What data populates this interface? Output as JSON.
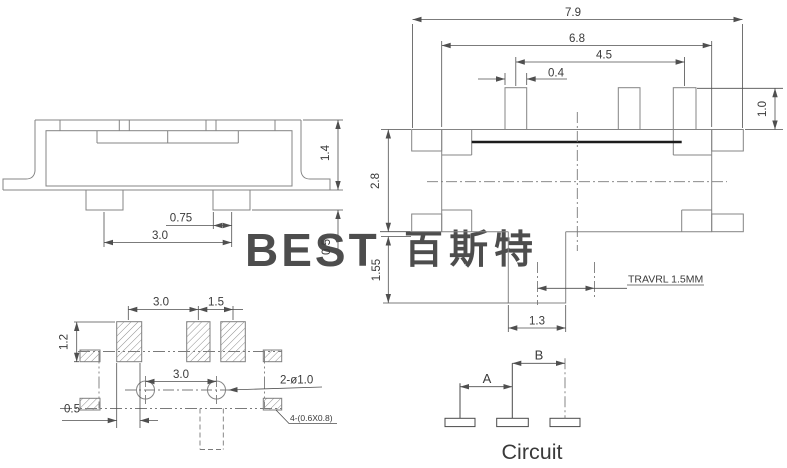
{
  "colors": {
    "line": "#848484",
    "dim": "#4f4f4f",
    "watermark": "#bed9f0"
  },
  "watermark": {
    "latin": "BEST",
    "cjk": "百斯特"
  },
  "side_view": {
    "height": "1.4",
    "pad_width": "0.75",
    "pad_pitch": "3.0",
    "standoff": "0.5"
  },
  "top_view": {
    "overall_width": "7.9",
    "body_width": "6.8",
    "pin_span": "4.5",
    "pin_width": "0.4",
    "pin_height": "1.0",
    "body_depth": "2.8",
    "knob_depth": "1.55",
    "knob_width": "1.3",
    "travel_note": "TRAVRL 1.5MM"
  },
  "footprint": {
    "pad_pitch_left": "3.0",
    "pad_pitch_right": "1.5",
    "pad_height": "1.2",
    "hole_pitch": "3.0",
    "hole_note": "2-ø1.0",
    "pad_offset": "0.5",
    "side_pad_note": "4-(0.6X0.8)"
  },
  "circuit": {
    "dim_a": "A",
    "dim_b": "B",
    "caption": "Circuit"
  }
}
